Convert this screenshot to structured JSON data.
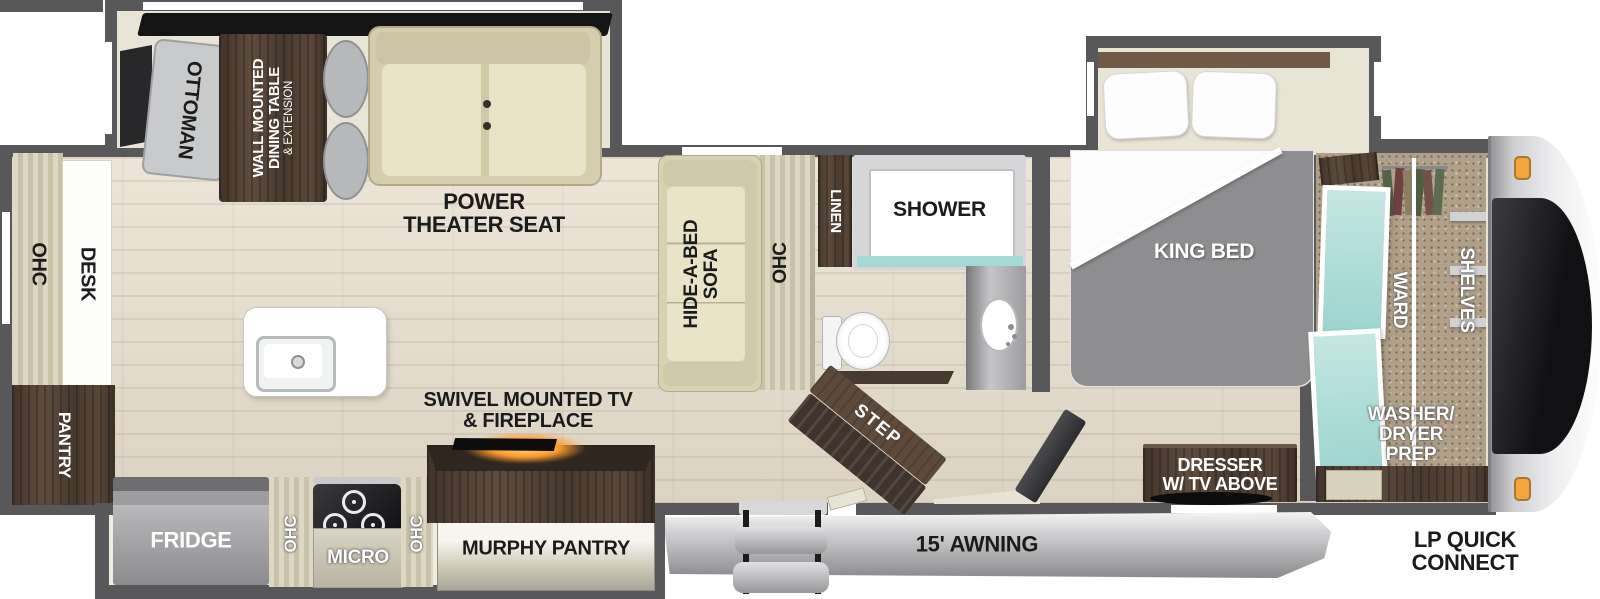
{
  "labels": {
    "ottoman": "OTTOMAN",
    "dining1": "WALL MOUNTED",
    "dining2": "DINING TABLE",
    "dining3": "& EXTENSION",
    "theater1": "POWER",
    "theater2": "THEATER SEAT",
    "sofa1": "HIDE-A-BED",
    "sofa2": "SOFA",
    "ohc_sofa": "OHC",
    "ohc_desk": "OHC",
    "desk": "DESK",
    "pantry": "PANTRY",
    "fridge": "FRIDGE",
    "ohc_kitchen_left": "OHC",
    "micro": "MICRO",
    "ohc_kitchen_right": "OHC",
    "murphy_pantry": "MURPHY PANTRY",
    "swivel1": "SWIVEL MOUNTED TV",
    "swivel2": "& FIREPLACE",
    "linen": "LINEN",
    "shower": "SHOWER",
    "step": "STEP",
    "king_bed": "KING BED",
    "dresser1": "DRESSER",
    "dresser2": "W/ TV ABOVE",
    "ward": "WARD",
    "shelves": "SHELVES",
    "wd1": "WASHER/",
    "wd2": "DRYER",
    "wd3": "PREP",
    "awning": "15' AWNING",
    "lp1": "LP QUICK",
    "lp2": "CONNECT"
  },
  "colors": {
    "wall": "#58585a",
    "wood": "#e6dfd2",
    "cream": "#e9e5d6",
    "dkwood": "#4e3f34",
    "mirror": "#a9ddd8",
    "glow": "#ff9d2e",
    "marker": "#f3a43e",
    "blanket": "#8e8e90"
  }
}
